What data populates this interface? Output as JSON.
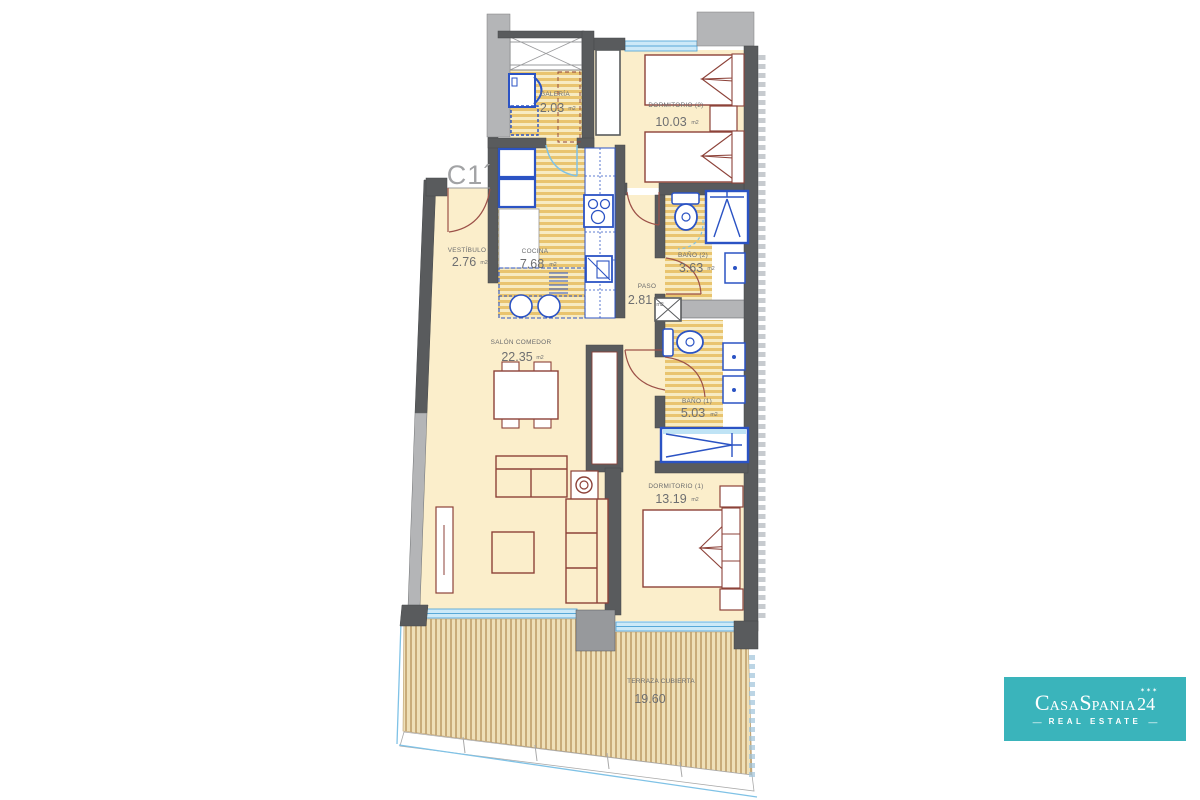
{
  "unit_label": "C1´",
  "plan": {
    "rooms": [
      {
        "id": "galeria",
        "name": "GALERÍA",
        "area": "2.03",
        "unit": "m2"
      },
      {
        "id": "dormitorio2",
        "name": "DORMITORIO (2)",
        "area": "10.03",
        "unit": "m2"
      },
      {
        "id": "vestibulo",
        "name": "VESTÍBULO",
        "area": "2.76",
        "unit": "m2"
      },
      {
        "id": "cocina",
        "name": "COCINA",
        "area": "7.68",
        "unit": "m2"
      },
      {
        "id": "paso",
        "name": "PASO",
        "area": "2.81",
        "unit": "m2"
      },
      {
        "id": "bano2",
        "name": "BAÑO (2)",
        "area": "3.63",
        "unit": "m2"
      },
      {
        "id": "salon",
        "name": "SALÓN COMEDOR",
        "area": "22.35",
        "unit": "m2"
      },
      {
        "id": "bano1",
        "name": "BAÑO (1)",
        "area": "5.03",
        "unit": "m2"
      },
      {
        "id": "dormitorio1",
        "name": "DORMITORIO (1)",
        "area": "13.19",
        "unit": "m2"
      },
      {
        "id": "terraza",
        "name": "TERRAZA CUBIERTA",
        "area": "19.60",
        "unit": ""
      }
    ]
  },
  "logo": {
    "c": "C",
    "asa": "ASA",
    "s": "S",
    "pania": "PANIA",
    "number": "24",
    "stars": "✶✶✶",
    "dash": "—",
    "tagline": "REAL ESTATE",
    "bg": "#3ab4bb"
  },
  "colors": {
    "wall": "#595b5d",
    "wall_light": "#b4b5b7",
    "floor": "#fbeecb",
    "stripe": "#e9c46f",
    "deck_stripe": "#c9ac7a",
    "fixture_blue": "#2b53c4",
    "furniture": "#8d4239",
    "window": "#cde9f8",
    "glass_accent": "#7fc2e6",
    "label": "#6b6c6e"
  }
}
